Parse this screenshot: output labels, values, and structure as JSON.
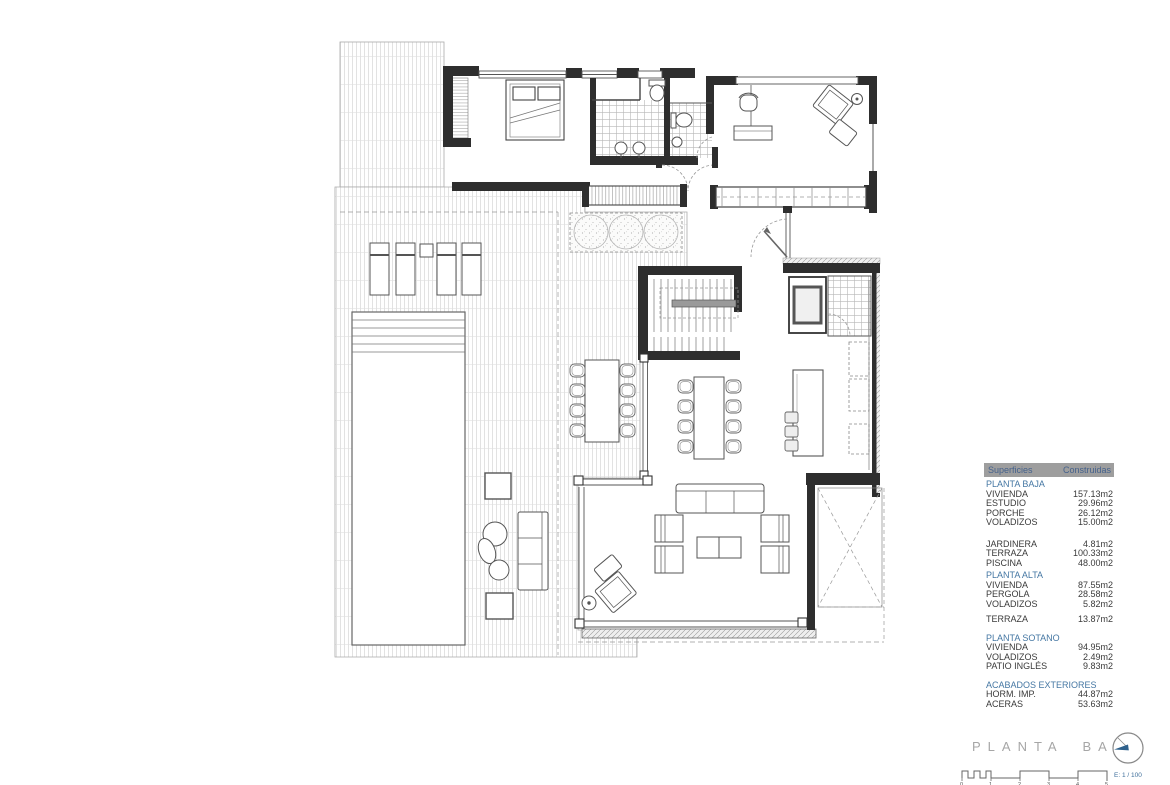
{
  "plan": {
    "title": "PLANTA BAJA",
    "scale_label": "E: 1 / 100",
    "scale_numbers": [
      "0",
      "1",
      "2",
      "3",
      "4",
      "5"
    ]
  },
  "colors": {
    "accent_blue": "#3f6f9b",
    "table_header_bg": "#9e9e9e",
    "table_header_text": "#44618c",
    "row_text": "#3a3a3a",
    "title_gray": "#a6a6a6"
  },
  "areas_table": {
    "headers": [
      "Superficies",
      "Construidas"
    ],
    "rows": [
      {
        "type": "section",
        "label": "PLANTA BAJA"
      },
      {
        "type": "item",
        "label": "VIVIENDA",
        "value": "157.13m2"
      },
      {
        "type": "item",
        "label": "ESTUDIO",
        "value": "29.96m2"
      },
      {
        "type": "item",
        "label": "PORCHE",
        "value": "26.12m2"
      },
      {
        "type": "item",
        "label": "VOLADIZOS",
        "value": "15.00m2"
      },
      {
        "type": "blank"
      },
      {
        "type": "blank"
      },
      {
        "type": "item",
        "label": "JARDINERA",
        "value": "4.81m2"
      },
      {
        "type": "item",
        "label": "TERRAZA",
        "value": "100.33m2"
      },
      {
        "type": "item",
        "label": "PISCINA",
        "value": "48.00m2"
      },
      {
        "type": "section",
        "label": "PLANTA ALTA"
      },
      {
        "type": "item",
        "label": "VIVIENDA",
        "value": "87.55m2"
      },
      {
        "type": "item",
        "label": "PERGOLA",
        "value": "28.58m2"
      },
      {
        "type": "item",
        "label": "VOLADIZOS",
        "value": "5.82m2"
      },
      {
        "type": "blank"
      },
      {
        "type": "item",
        "label": "TERRAZA",
        "value": "13.87m2"
      },
      {
        "type": "blank"
      },
      {
        "type": "section",
        "label": "PLANTA SOTANO"
      },
      {
        "type": "item",
        "label": "VIVIENDA",
        "value": "94.95m2"
      },
      {
        "type": "item",
        "label": "VOLADIZOS",
        "value": "2.49m2"
      },
      {
        "type": "item",
        "label": "PATIO INGLÉS",
        "value": "9.83m2"
      },
      {
        "type": "blank"
      },
      {
        "type": "section",
        "label": "ACABADOS EXTERIORES"
      },
      {
        "type": "item",
        "label": "HORM. IMP.",
        "value": "44.87m2"
      },
      {
        "type": "item",
        "label": "ACERAS",
        "value": "53.63m2"
      }
    ]
  }
}
